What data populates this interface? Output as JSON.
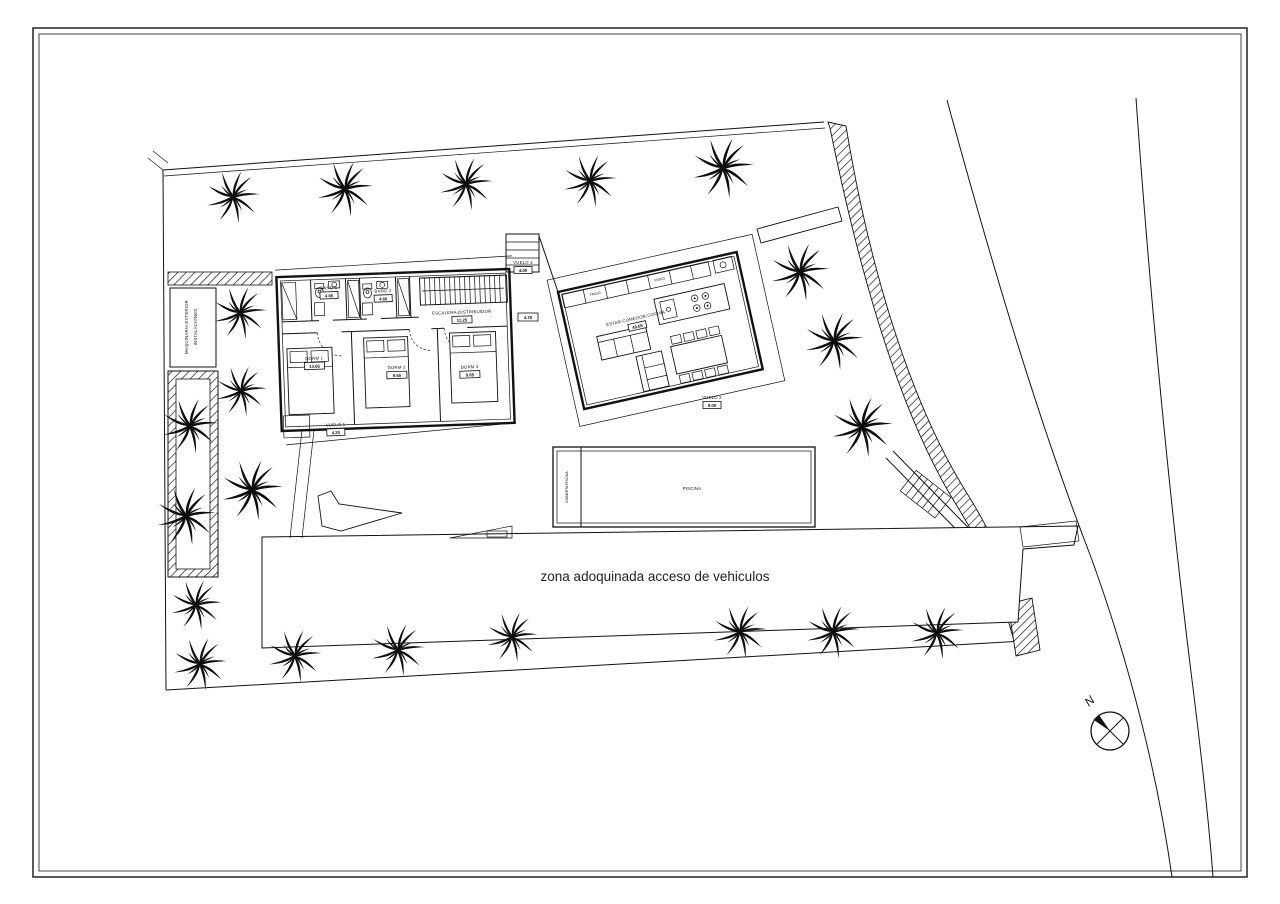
{
  "plan": {
    "driveway_label": "zona adoquinada acceso de vehiculos",
    "compass": {
      "north": "N"
    },
    "left_strip": {
      "line1": "MAQUINARIA EXTERIOR",
      "line2": "INSTALACIONES"
    },
    "pool": {
      "cover": "CUBIERTA PISCINA",
      "name": "PISCINA"
    },
    "kitchen": {
      "fridge1": "FRIGO",
      "fridge2": "FRIGO"
    },
    "rooms": {
      "bano1": {
        "name": "BAÑO 1",
        "area": "4.65"
      },
      "bano2": {
        "name": "BAÑO 2",
        "area": "4.60"
      },
      "escalera": {
        "name": "ESCALERA-DISTRIBUIDOR",
        "area": "11.25"
      },
      "dorm1": {
        "name": "DORM 1",
        "area": "13.65"
      },
      "dorm2": {
        "name": "DORM 2",
        "area": "9.65"
      },
      "dorm3": {
        "name": "DORM 3",
        "area": "9.65"
      },
      "estar": {
        "name": "ESTAR-COMEDOR-COCINA",
        "area": "49.65"
      },
      "paso": {
        "area": "4.70"
      },
      "vuelo1": {
        "name": "VUELO 1",
        "area": "4.20"
      },
      "vuelo2": {
        "name": "VUELO 2",
        "area": "9.00"
      },
      "vuelo3": {
        "name": "VUELO 3",
        "area": "4.00"
      }
    }
  }
}
